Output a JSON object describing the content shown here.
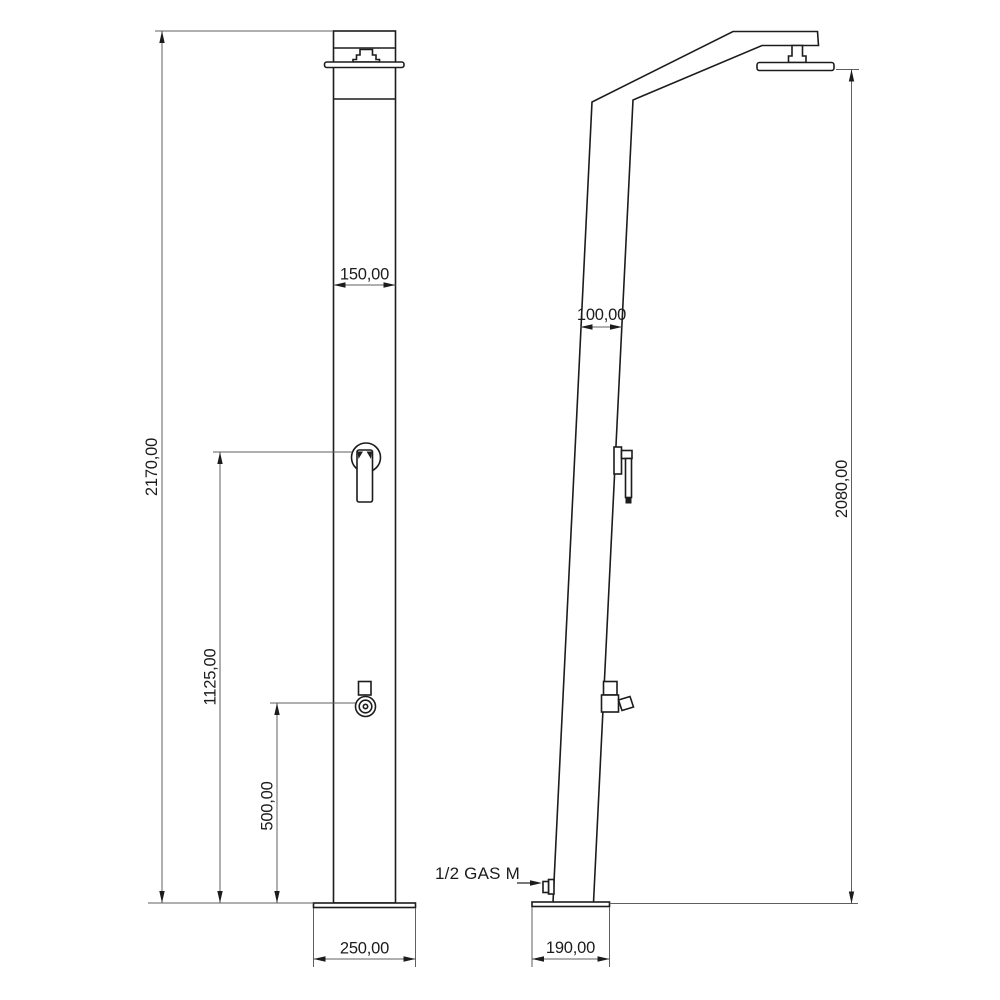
{
  "front_view": {
    "dim_column_width": "150,00",
    "dim_total_height": "2170,00",
    "dim_mixer_height": "1125,00",
    "dim_tap_height": "500,00",
    "dim_base_width": "250,00"
  },
  "side_view": {
    "dim_column_depth": "100,00",
    "dim_head_height": "2080,00",
    "dim_base_depth": "190,00",
    "inlet_label": "1/2 GAS M"
  },
  "colors": {
    "object_line": "#1c1c1c",
    "dimension_line": "#5f5f5f",
    "text": "#1c1c1c",
    "background": "#ffffff"
  }
}
